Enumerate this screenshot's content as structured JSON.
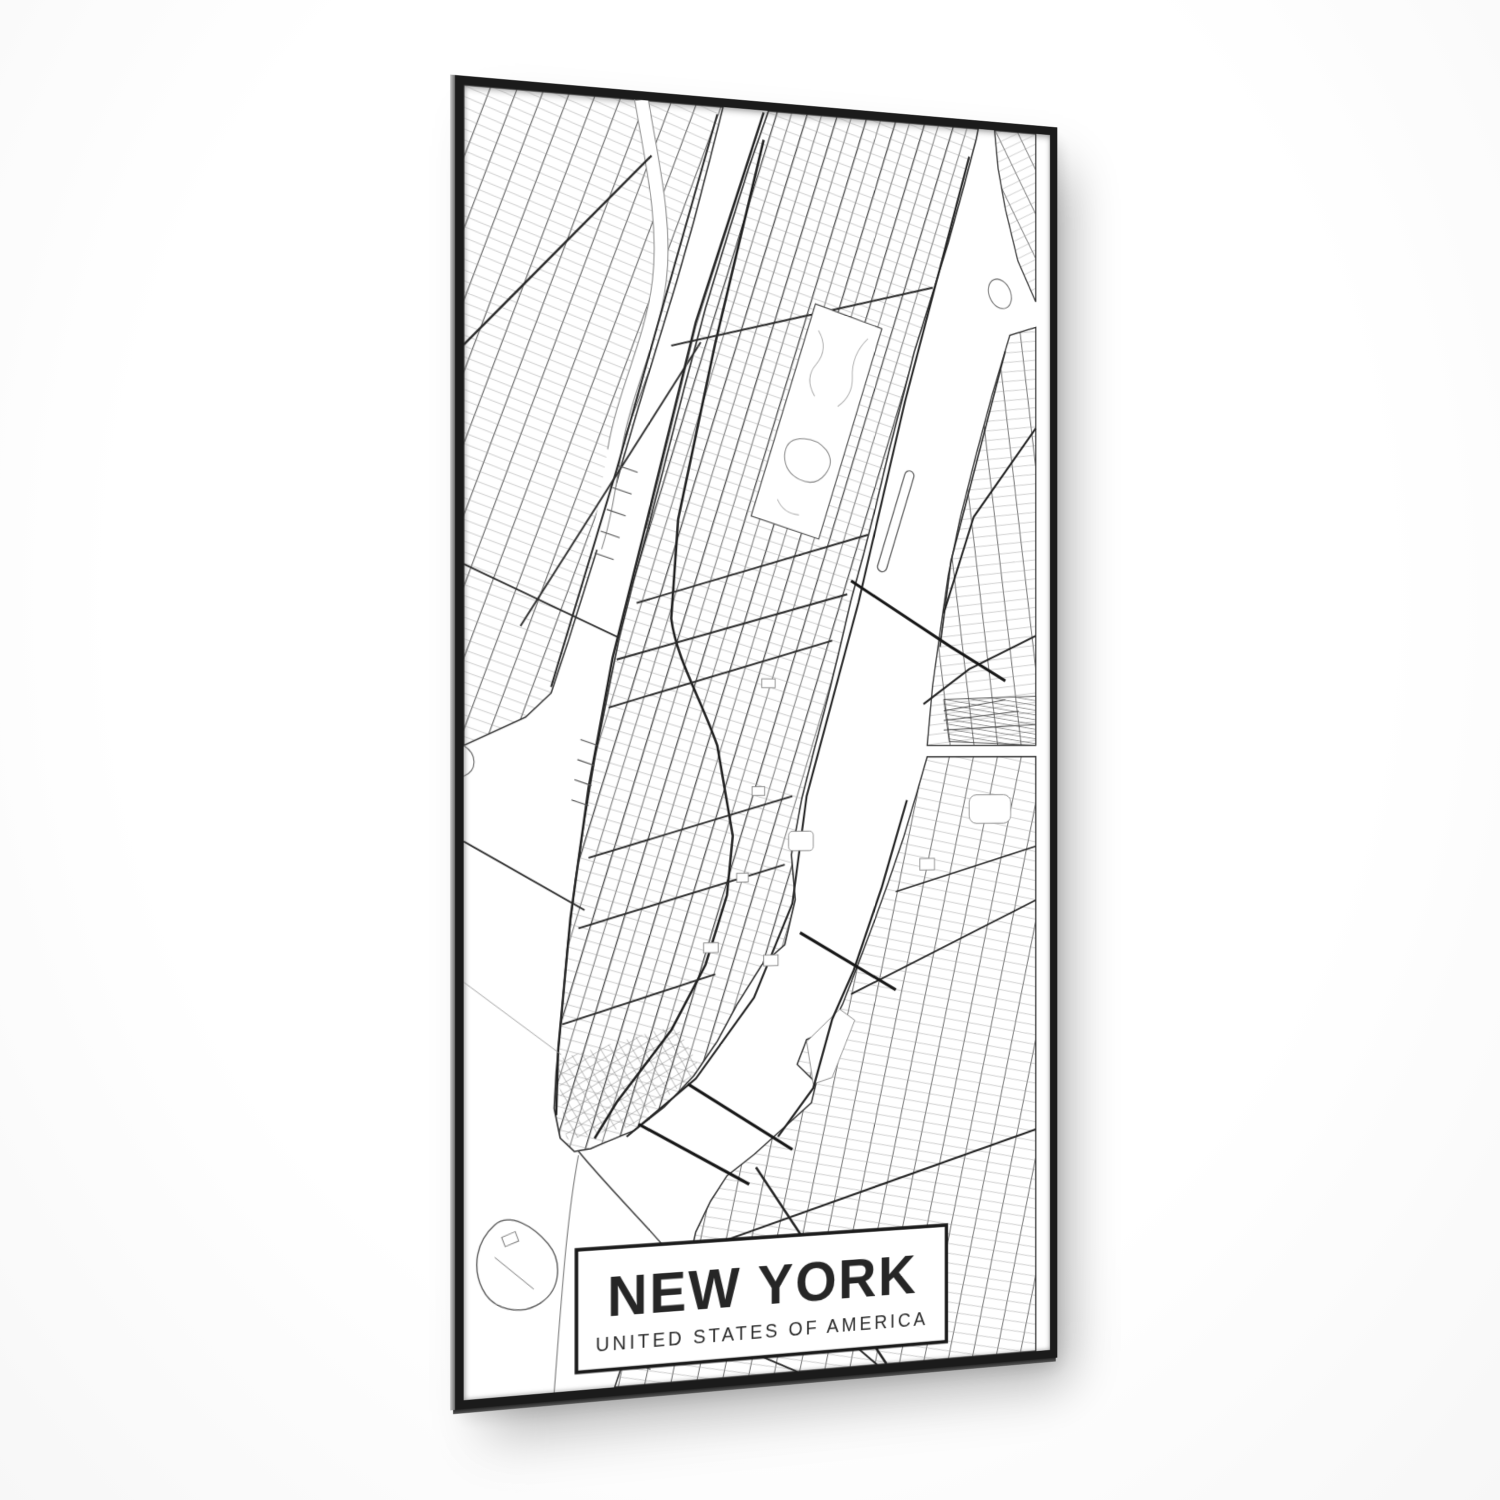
{
  "poster": {
    "title": "NEW YORK",
    "subtitle": "UNITED STATES OF AMERICA"
  },
  "colors": {
    "frame": "#1b1b1b",
    "major_street": "#2d2d2d",
    "minor_street": "#9a9a9a",
    "shoreline": "#2f2f2f",
    "paper": "#ffffff",
    "photo_background": "#fcfcfc"
  }
}
